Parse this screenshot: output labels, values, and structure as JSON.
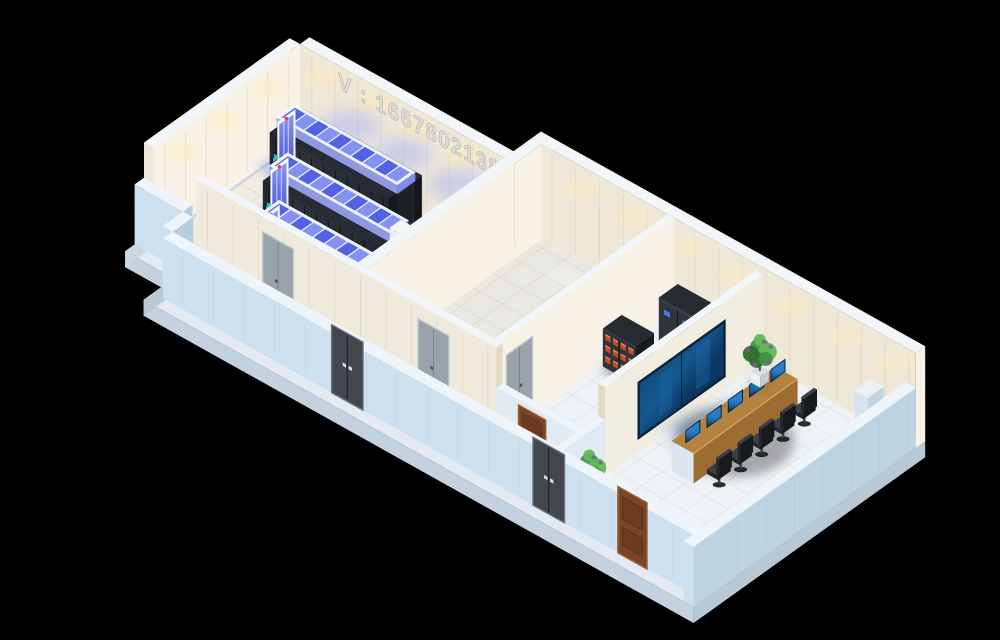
{
  "meta": {
    "description": "Isometric 3D cutaway render of a data center suite",
    "canvas": {
      "width": 1000,
      "height": 640
    }
  },
  "watermark": {
    "text": "V : 16678021386",
    "color": "#d8d8d8"
  },
  "palette": {
    "bg": "#000000",
    "slabTop": "#e3eaf1",
    "slabSide": "#b9c8d5",
    "slabWest": "#cbd8e3",
    "wallTop": "#f3f6f8",
    "cream": "#efe8d8",
    "creamLit": "#f7f2e5",
    "creamSeam": "#c9bfa8",
    "creamEnd": "#e2d9c6",
    "lowTop": "#edf4fa",
    "lowOuter": "#cde0ef",
    "lowEnd": "#b6cddd",
    "lowInner": "#e0eaf2",
    "floorServer": "#f1ece0",
    "floorServerLine": "#dcd4c0",
    "floorPower": "#eae8e2",
    "floorCool": "#eef1f5",
    "floorCoolLine": "#d8e0e8",
    "rackTop": "#272b33",
    "rackFace": "#2c313a",
    "rackRight": "#15171c",
    "rackSeam": "#0f1114",
    "rackEnd": "#23262d",
    "roofFrame": "#eef2fb",
    "roofSide": "#98a4f2",
    "paneA": "#4c5ce2",
    "paneB": "#7e8cf3",
    "doorFrame": "#f3f6fb",
    "glassHi": "#8b98f6",
    "glassLo": "#3c4bd0",
    "redDot": "#e23b2f",
    "cyanTag": "#38c6d6",
    "cabDark": "#262a31",
    "cabFace": "#2e333c",
    "cabRight": "#171a1f",
    "dispBlue": "#4a79e8",
    "battA": "#c7502a",
    "battB": "#f08a55",
    "vwFrame": "#0a2338",
    "vwDeep": "#0c3a66",
    "vwLight": "#2179bd",
    "deskTop": "#b5823f",
    "deskFront": "#9c6c33",
    "deskEnd": "#dde6ee",
    "deskEdge": "#d9ab6b",
    "monDark": "#0b3e74",
    "monHi": "#2f93e8",
    "chairDark": "#23262c",
    "chairMid": "#3a3f48",
    "potWhite": "#eef0f2",
    "potShade": "#c5ccd2",
    "trunk": "#6b4a2a",
    "leafA": "#3e9440",
    "leafB": "#2c6f2e",
    "leafC": "#63b95c",
    "flower": "#8a55a8",
    "metalDoor": "#42474d",
    "metalFrame": "#6a727a",
    "metalHandle": "#d7dde3",
    "grayDoor": "#9aa2aa",
    "grayFrame": "#bcc4cc",
    "woodDoor": "#7a4527",
    "woodPanel": "#6b3a1f",
    "woodFrame": "#91602f",
    "pillarTop": "#eaf1f7",
    "pillarL": "#d7e4ef",
    "pillarR": "#c2d4e2",
    "warmGlow": "#ffe9b4",
    "blueGlow": "#93a0ff",
    "floorBlue": "#8e9cf5",
    "coolPool": "#ffffff",
    "vwGlow": "#4b86c8"
  },
  "building": {
    "slab_outline": [
      [
        -12,
        -12
      ],
      [
        240,
        -12
      ],
      [
        240,
        -47
      ],
      [
        692,
        -47
      ],
      [
        692,
        247
      ],
      [
        45,
        247
      ],
      [
        45,
        209
      ],
      [
        -12,
        209
      ]
    ],
    "floors": [
      {
        "id": "server-room-floor",
        "rect": [
          0,
          0,
          240,
          185
        ],
        "fill": "floorServer",
        "line": "floorServerLine"
      },
      {
        "id": "power-room-floor",
        "rect": [
          252,
          -35,
          148,
          220
        ],
        "fill": "floorPower",
        "line": "floorServerLine"
      },
      {
        "id": "front-corridor-floor",
        "rect": [
          57,
          185,
          447,
          38
        ],
        "fill": "floorCool",
        "line": "floorCoolLine"
      },
      {
        "id": "hall-floor",
        "rect": [
          408,
          -35,
          96,
          220
        ],
        "fill": "floorCool",
        "line": "floorCoolLine"
      },
      {
        "id": "monitoring-room-floor",
        "rect": [
          512,
          -35,
          168,
          258
        ],
        "fill": "floorCool",
        "line": "floorCoolLine"
      }
    ],
    "walls": {
      "west-wall": [
        -12,
        0,
        12,
        185,
        95
      ],
      "server-far-wall": [
        0,
        -12,
        240,
        12,
        95
      ],
      "step-wall": [
        240,
        -47,
        12,
        47,
        95
      ],
      "right-far-wall": [
        252,
        -47,
        440,
        12,
        95
      ],
      "server-east-wall": [
        240,
        0,
        12,
        185,
        95
      ],
      "front-partition": [
        57,
        185,
        353,
        8,
        95
      ],
      "front-partition-low": [
        410,
        185,
        100,
        8,
        55
      ],
      "hall-partition": [
        400,
        -35,
        8,
        220,
        95
      ],
      "monitoring-partition": [
        504,
        -35,
        8,
        200,
        88
      ],
      "monitoring-partition-low": [
        504,
        165,
        8,
        58,
        55
      ],
      "front-left-low-wall": [
        -12,
        185,
        57,
        12,
        60
      ],
      "connector-low-wall": [
        45,
        197,
        12,
        26,
        60
      ],
      "front-low-wall": [
        57,
        223,
        635,
        12,
        60
      ],
      "east-low-wall": [
        680,
        -35,
        12,
        282,
        60
      ]
    }
  },
  "equipment": {
    "rack_pods": [
      {
        "id": "rack-pod-1",
        "x": 22,
        "y": 20,
        "len": 140
      },
      {
        "id": "rack-pod-2",
        "x": 62,
        "y": 72,
        "len": 140
      },
      {
        "id": "rack-pod-3",
        "x": 100,
        "y": 124,
        "len": 138
      }
    ],
    "column": {
      "x": 226,
      "y": 116,
      "w": 14,
      "d": 14,
      "h": 92
    },
    "cabinets": [
      {
        "id": "ups-cabinet-row",
        "type": "ups",
        "x": 424,
        "y": -22,
        "w": 66,
        "d": 24,
        "h": 44,
        "bays": 3
      },
      {
        "id": "battery-cabinet",
        "type": "battery",
        "x": 410,
        "y": 34,
        "w": 38,
        "d": 24,
        "h": 38
      },
      {
        "id": "supply-crate",
        "type": "crate",
        "x": 478,
        "y": 64,
        "w": 20,
        "d": 14,
        "h": 13
      }
    ],
    "monitoring": {
      "video_wall": {
        "y0": 12,
        "y1": 124,
        "z0": 12,
        "z1": 70
      },
      "desk": {
        "x": 552,
        "y": -8,
        "w": 26,
        "d": 132,
        "h": 30
      },
      "stations_y": [
        4,
        31,
        58,
        85,
        112
      ],
      "plants": [
        {
          "x": 528,
          "y": -14
        },
        {
          "x": 522,
          "y": 196
        }
      ],
      "corner_pillar": {
        "x": 652,
        "y": -20,
        "w": 16,
        "d": 20,
        "h": 58
      }
    },
    "doors": {
      "metal_outer_x": [
        255,
        492
      ],
      "wood_outer_x": [
        592
      ],
      "gray_partition_x": [
        135,
        318
      ],
      "hall_door_y": 145,
      "inner_wood_x": 436
    }
  }
}
